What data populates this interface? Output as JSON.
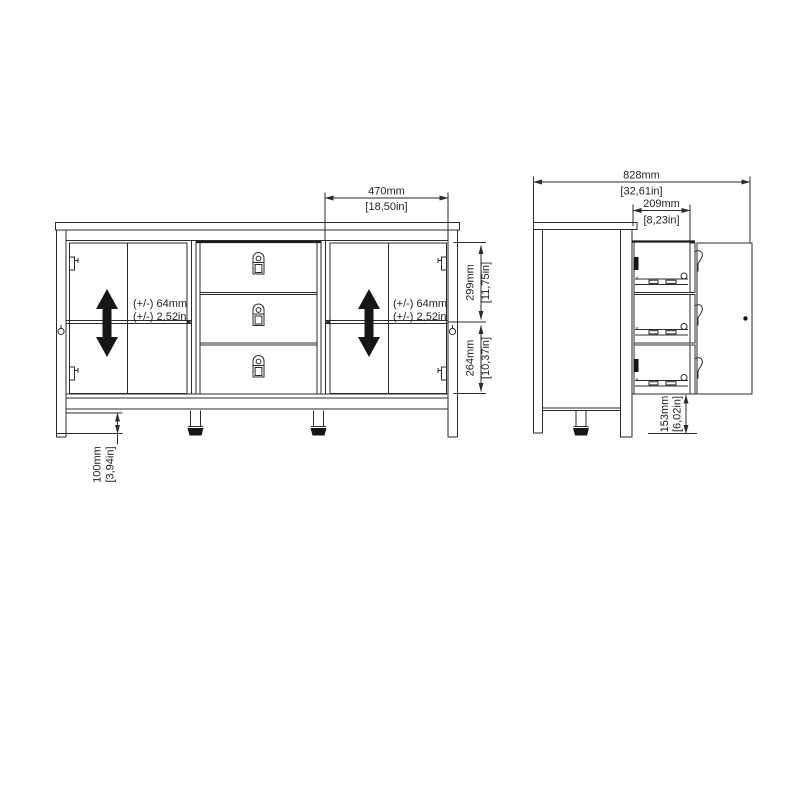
{
  "diagram": {
    "type": "furniture-dimension-drawing",
    "subject": "sideboard with two double-door compartments and three center drawers",
    "colors": {
      "background": "#ffffff",
      "line": "#2b2b2b",
      "solid_fill": "#161616",
      "text": "#1f1f1f"
    },
    "front_view": {
      "dimensions": {
        "door_section_width": {
          "mm": "470mm",
          "inch": "[18,50in]"
        },
        "upper_door_height": {
          "mm": "299mm",
          "inch": "[11,75in]"
        },
        "lower_door_height": {
          "mm": "264mm",
          "inch": "[10,37in]"
        },
        "leg_clearance": {
          "mm": "100mm",
          "inch": "[3,94in]"
        }
      },
      "shelf_adjustment_left": {
        "line1": "(+/-) 64mm",
        "line2": "(+/-) 2,52in"
      },
      "shelf_adjustment_right": {
        "line1": "(+/-) 64mm",
        "line2": "(+/-) 2,52in"
      }
    },
    "side_view": {
      "dimensions": {
        "total_depth_door_open": {
          "mm": "828mm",
          "inch": "[32,61in]"
        },
        "drawer_extension": {
          "mm": "209mm",
          "inch": "[8,23in]"
        },
        "bottom_clearance": {
          "mm": "153mm",
          "inch": "[6,02in]"
        }
      }
    },
    "icons": {
      "shelf_adjust_arrow": "double-vertical-arrow",
      "drawer_handle": "vertical-pull-handle",
      "adjustable_foot": "leveling-foot"
    }
  }
}
